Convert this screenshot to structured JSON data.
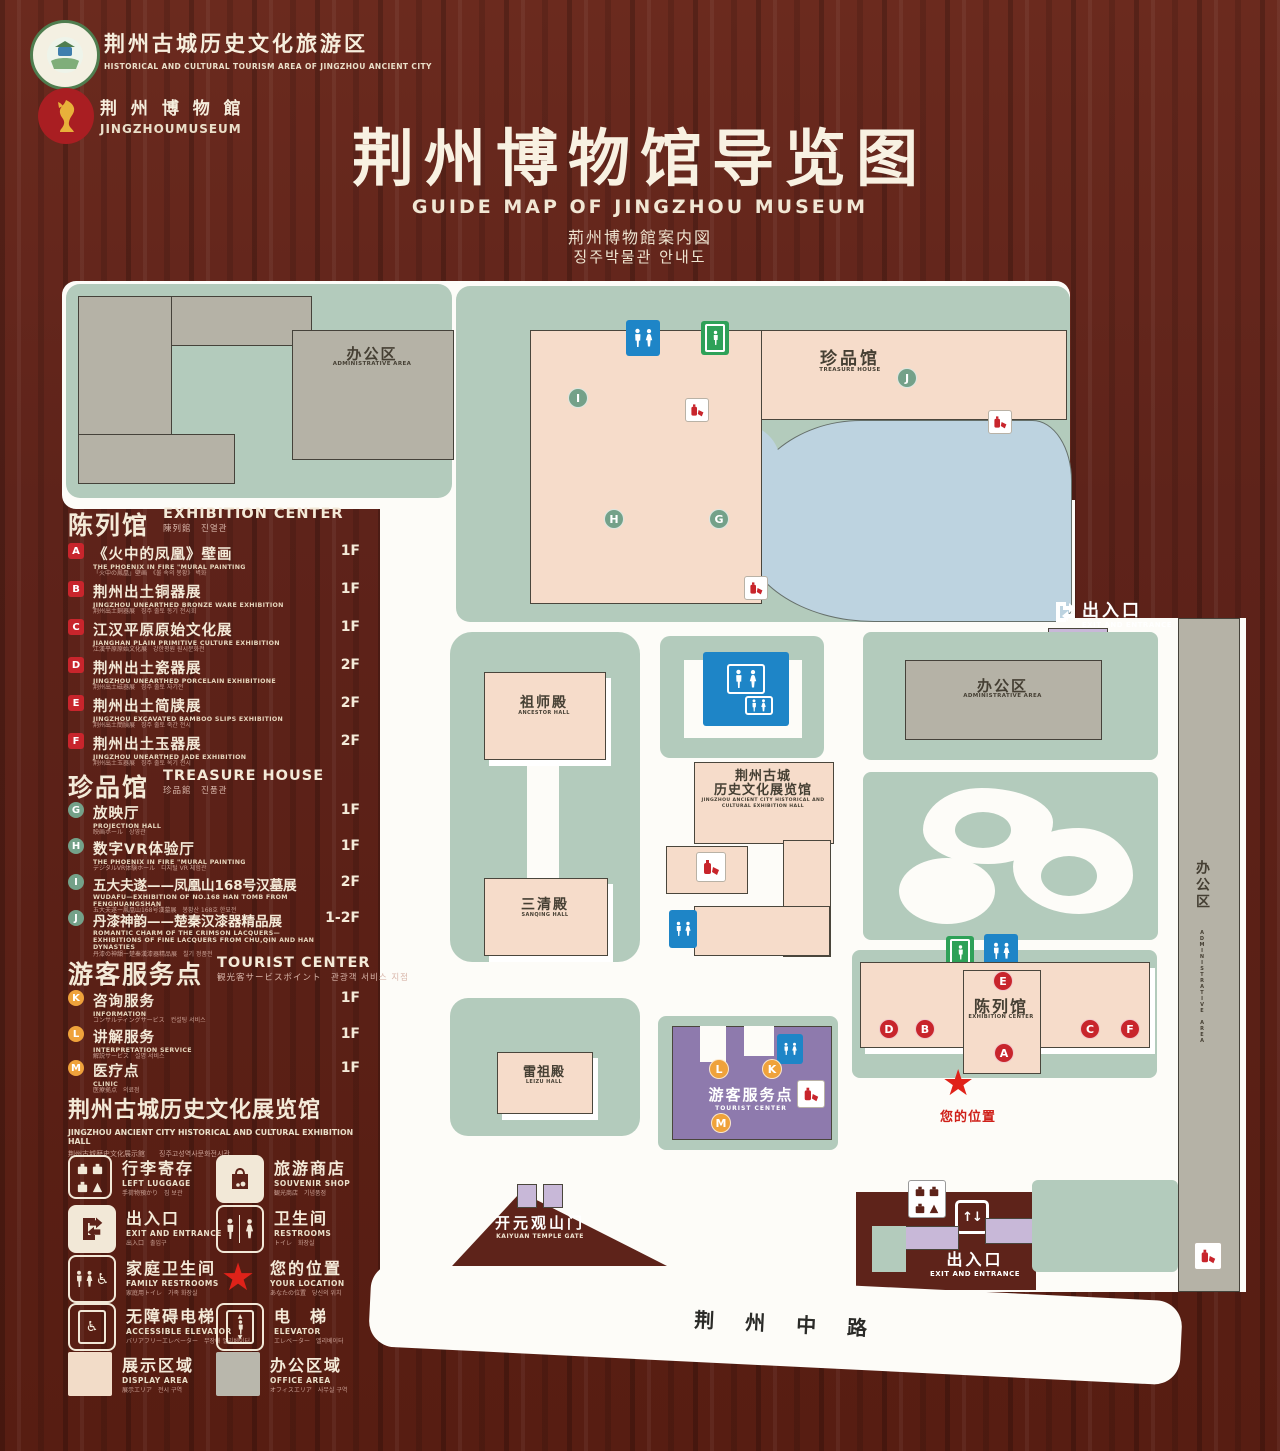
{
  "header": {
    "logo1": {
      "title": "荆州古城历史文化旅游区",
      "subtitle": "HISTORICAL AND CULTURAL TOURISM AREA OF JINGZHOU ANCIENT CITY"
    },
    "logo2": {
      "title": "荆 州 博 物 館",
      "subtitle": "JINGZHOUMUSEUM"
    },
    "title": "荆州博物馆导览图",
    "title_en": "GUIDE MAP OF JINGZHOU MUSEUM",
    "title_jp": "荊州博物館案内図",
    "title_kr": "징주박물관 안내도"
  },
  "sections": {
    "exhibition": {
      "cn": "陈列馆",
      "en": "EXHIBITION CENTER",
      "sub": "陳列館　진열관",
      "items": [
        {
          "letter": "A",
          "cn": "《火中的凤凰》壁画",
          "en": "THE PHOENIX IN FIRE \"MURAL PAINTING",
          "sub": "「火中の鳳凰」壁画　《불 속의 봉황》 벽화",
          "floor": "1F"
        },
        {
          "letter": "B",
          "cn": "荆州出土铜器展",
          "en": "JINGZHOU UNEARTHED BRONZE WARE EXHIBITION",
          "sub": "荆州出土銅器展　징주 출토 동기 전시회",
          "floor": "1F"
        },
        {
          "letter": "C",
          "cn": "江汉平原原始文化展",
          "en": "JIANGHAN PLAIN PRIMITIVE CULTURE EXHIBITION",
          "sub": "江漢平原原始文化展　강한평원 원시문화전",
          "floor": "1F"
        },
        {
          "letter": "D",
          "cn": "荆州出土瓷器展",
          "en": "JINGZHOU UNEARTHED PORCELAIN EXHIBITIONE",
          "sub": "荆州出土磁器展　징주 출토 자기전",
          "floor": "2F"
        },
        {
          "letter": "E",
          "cn": "荆州出土简牍展",
          "en": "JINGZHOU EXCAVATED BAMBOO SLIPS EXHIBITION",
          "sub": "荆州出土簡牘展　징주 출토 죽간 전시",
          "floor": "2F"
        },
        {
          "letter": "F",
          "cn": "荆州出土玉器展",
          "en": "JINGZHOU UNEARTHED JADE EXHIBITION",
          "sub": "荆州出土玉器展　징주 출토 옥기 전시",
          "floor": "2F"
        }
      ]
    },
    "treasure": {
      "cn": "珍品馆",
      "en": "TREASURE HOUSE",
      "sub": "珍品館　진품관",
      "items": [
        {
          "letter": "G",
          "cn": "放映厅",
          "en": "PROJECTION HALL",
          "sub": "映画ホール　상영관",
          "floor": "1F"
        },
        {
          "letter": "H",
          "cn": "数字VR体验厅",
          "en": "THE PHOENIX IN FIRE \"MURAL PAINTING",
          "sub": "デジタルVR体験ホール　디지털 VR 체험관",
          "floor": "1F"
        },
        {
          "letter": "I",
          "cn": "五大夫遂——凤凰山168号汉墓展",
          "en": "WUDAFU—EXHIBITION OF NO.168 HAN TOMB FROM FENGHUANGSHAN",
          "sub": "五大夫遂ー鳳凰山168号漢墓展　봉황산 168호 한묘전",
          "floor": "2F"
        },
        {
          "letter": "J",
          "cn": "丹漆神韵——楚秦汉漆器精品展",
          "en": "ROMANTIC CHARM OF THE CRIMSON LACQUERS— EXHIBITIONS OF FINE LACQUERS FROM CHU,QIN AND HAN DYNASTIES",
          "sub": "丹漆の神韻ー楚秦漢漆器精品展　칠기 정품전",
          "floor": "1-2F"
        }
      ]
    },
    "tourist": {
      "cn": "游客服务点",
      "en": "TOURIST CENTER",
      "sub": "観光客サービスポイント　관광객 서비스 지점",
      "items": [
        {
          "letter": "K",
          "cn": "咨询服务",
          "en": "INFORMATION",
          "sub": "コンサルティングサービス　컨설팅 서비스",
          "floor": "1F"
        },
        {
          "letter": "L",
          "cn": "讲解服务",
          "en": "INTERPRETATION SERVICE",
          "sub": "解説サービス　설명 서비스",
          "floor": "1F"
        },
        {
          "letter": "M",
          "cn": "医疗点",
          "en": "CLINIC",
          "sub": "医療拠点　의료점",
          "floor": "1F"
        }
      ]
    },
    "hall_heading": {
      "cn": "荆州古城历史文化展览馆",
      "en": "JINGZHOU ANCIENT CITY HISTORICAL AND CULTURAL EXHIBITION HALL",
      "sub": "荆州古城歴史文化展示館　　징주고성역사문화전시관"
    }
  },
  "legend": {
    "luggage": {
      "cn": "行李寄存",
      "en": "LEFT LUGGAGE",
      "sub": "手荷物預かり　짐 보관"
    },
    "shop": {
      "cn": "旅游商店",
      "en": "SOUVENIR SHOP",
      "sub": "観光商店　기념품점"
    },
    "exit": {
      "cn": "出入口",
      "en": "EXIT AND ENTRANCE",
      "sub": "出入口　출입구"
    },
    "restroom": {
      "cn": "卫生间",
      "en": "RESTROOMS",
      "sub": "トイレ　화장실"
    },
    "family": {
      "cn": "家庭卫生间",
      "en": "FAMILY RESTROOMS",
      "sub": "家庭用トイレ　가족 화장실"
    },
    "location": {
      "cn": "您的位置",
      "en": "YOUR LOCATION",
      "sub": "あなたの位置　당신의 위치"
    },
    "acc_elevator": {
      "cn": "无障碍电梯",
      "en": "ACCESSIBLE ELEVATOR",
      "sub": "バリアフリーエレベーター　무장애 엘리베이터"
    },
    "elevator": {
      "cn": "电　梯",
      "en": "ELEVATOR",
      "sub": "エレベーター　엘리베이터"
    },
    "display_area": {
      "cn": "展示区域",
      "en": "DISPLAY AREA",
      "sub": "展示エリア　전시 구역"
    },
    "office_area": {
      "cn": "办公区域",
      "en": "OFFICE AREA",
      "sub": "オフィスエリア　사무실 구역"
    }
  },
  "map": {
    "admin_nw": {
      "cn": "办公区",
      "en": "ADMINISTRATIVE AREA"
    },
    "treasure": {
      "cn": "珍品馆",
      "en": "TREASURE HOUSE"
    },
    "exit_ne": {
      "cn": "出入口",
      "en": "EXIT AND ENTRANCE"
    },
    "admin_e": {
      "cn": "办公区",
      "en": "ADMINISTRATIVE AREA"
    },
    "admin_strip": {
      "cn": "办公区",
      "en": "ADMINISTRATIVE AREA"
    },
    "ancestor": {
      "cn": "祖师殿",
      "en": "ANCESTOR HALL"
    },
    "sanqing": {
      "cn": "三清殿",
      "en": "SANQING HALL"
    },
    "leizu": {
      "cn": "雷祖殿",
      "en": "LEIZU HALL"
    },
    "jz_hall": {
      "cn1": "荆州古城",
      "cn2": "历史文化展览馆",
      "en": "JINGZHOU ANCIENT CITY HISTORICAL AND CULTURAL EXHIBITION HALL"
    },
    "exhibition": {
      "cn": "陈列馆",
      "en": "EXHIBITION CENTER"
    },
    "tourist": {
      "cn": "游客服务点",
      "en": "TOURIST CENTER"
    },
    "your_location": "您的位置",
    "kaiyuan": {
      "cn": "开元观山门",
      "en": "KAIYUAN TEMPLE GATE"
    },
    "exit_s": {
      "cn": "出入口",
      "en": "EXIT AND ENTRANCE"
    },
    "road": "荆 州 中 路",
    "markers": [
      "I",
      "J",
      "H",
      "G",
      "E",
      "D",
      "B",
      "A",
      "C",
      "F",
      "L",
      "K",
      "M"
    ]
  },
  "colors": {
    "wood": "#5e231a",
    "map_green": "#b3cbbc",
    "building_pink": "#f6dcca",
    "office_gray": "#b5b2a6",
    "water_blue": "#bdd3e0",
    "tourist_purple": "#8e7aad",
    "gate_purple": "#c8b8d8",
    "badge_red": "#c8252c",
    "badge_green": "#74a189",
    "badge_orange": "#efa23b",
    "sign_blue": "#1e85c7",
    "sign_green": "#2ea158",
    "star_red": "#e02219"
  }
}
